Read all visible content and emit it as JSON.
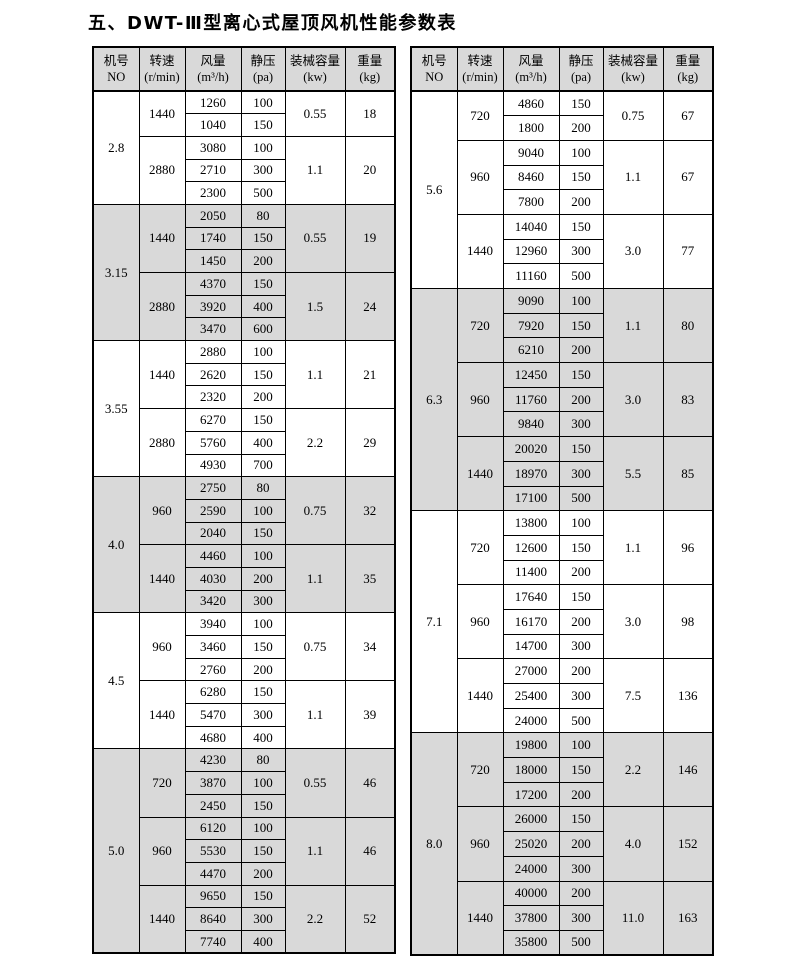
{
  "title": "五、DWT-Ⅲ型离心式屋顶风机性能参数表",
  "columns": [
    {
      "line1": "机号",
      "line2": "NO"
    },
    {
      "line1": "转速",
      "line2": "(r/min)"
    },
    {
      "line1": "风量",
      "line2": "(m³/h)"
    },
    {
      "line1": "静压",
      "line2": "(pa)"
    },
    {
      "line1": "装械容量",
      "line2": "(kw)"
    },
    {
      "line1": "重量",
      "line2": "(kg)"
    }
  ],
  "tables": [
    {
      "side": "left",
      "sections": [
        {
          "no": "2.8",
          "shaded": false,
          "groups": [
            {
              "speed": "1440",
              "rows": [
                [
                  "1260",
                  "100"
                ],
                [
                  "1040",
                  "150"
                ]
              ],
              "kw": "0.55",
              "kg": "18"
            },
            {
              "speed": "2880",
              "rows": [
                [
                  "3080",
                  "100"
                ],
                [
                  "2710",
                  "300"
                ],
                [
                  "2300",
                  "500"
                ]
              ],
              "kw": "1.1",
              "kg": "20"
            }
          ]
        },
        {
          "no": "3.15",
          "shaded": true,
          "groups": [
            {
              "speed": "1440",
              "rows": [
                [
                  "2050",
                  "80"
                ],
                [
                  "1740",
                  "150"
                ],
                [
                  "1450",
                  "200"
                ]
              ],
              "kw": "0.55",
              "kg": "19"
            },
            {
              "speed": "2880",
              "rows": [
                [
                  "4370",
                  "150"
                ],
                [
                  "3920",
                  "400"
                ],
                [
                  "3470",
                  "600"
                ]
              ],
              "kw": "1.5",
              "kg": "24"
            }
          ]
        },
        {
          "no": "3.55",
          "shaded": false,
          "groups": [
            {
              "speed": "1440",
              "rows": [
                [
                  "2880",
                  "100"
                ],
                [
                  "2620",
                  "150"
                ],
                [
                  "2320",
                  "200"
                ]
              ],
              "kw": "1.1",
              "kg": "21"
            },
            {
              "speed": "2880",
              "rows": [
                [
                  "6270",
                  "150"
                ],
                [
                  "5760",
                  "400"
                ],
                [
                  "4930",
                  "700"
                ]
              ],
              "kw": "2.2",
              "kg": "29"
            }
          ]
        },
        {
          "no": "4.0",
          "shaded": true,
          "groups": [
            {
              "speed": "960",
              "rows": [
                [
                  "2750",
                  "80"
                ],
                [
                  "2590",
                  "100"
                ],
                [
                  "2040",
                  "150"
                ]
              ],
              "kw": "0.75",
              "kg": "32"
            },
            {
              "speed": "1440",
              "rows": [
                [
                  "4460",
                  "100"
                ],
                [
                  "4030",
                  "200"
                ],
                [
                  "3420",
                  "300"
                ]
              ],
              "kw": "1.1",
              "kg": "35"
            }
          ]
        },
        {
          "no": "4.5",
          "shaded": false,
          "groups": [
            {
              "speed": "960",
              "rows": [
                [
                  "3940",
                  "100"
                ],
                [
                  "3460",
                  "150"
                ],
                [
                  "2760",
                  "200"
                ]
              ],
              "kw": "0.75",
              "kg": "34"
            },
            {
              "speed": "1440",
              "rows": [
                [
                  "6280",
                  "150"
                ],
                [
                  "5470",
                  "300"
                ],
                [
                  "4680",
                  "400"
                ]
              ],
              "kw": "1.1",
              "kg": "39"
            }
          ]
        },
        {
          "no": "5.0",
          "shaded": true,
          "groups": [
            {
              "speed": "720",
              "rows": [
                [
                  "4230",
                  "80"
                ],
                [
                  "3870",
                  "100"
                ],
                [
                  "2450",
                  "150"
                ]
              ],
              "kw": "0.55",
              "kg": "46"
            },
            {
              "speed": "960",
              "rows": [
                [
                  "6120",
                  "100"
                ],
                [
                  "5530",
                  "150"
                ],
                [
                  "4470",
                  "200"
                ]
              ],
              "kw": "1.1",
              "kg": "46"
            },
            {
              "speed": "1440",
              "rows": [
                [
                  "9650",
                  "150"
                ],
                [
                  "8640",
                  "300"
                ],
                [
                  "7740",
                  "400"
                ]
              ],
              "kw": "2.2",
              "kg": "52"
            }
          ]
        }
      ]
    },
    {
      "side": "right",
      "sections": [
        {
          "no": "5.6",
          "shaded": false,
          "groups": [
            {
              "speed": "720",
              "rows": [
                [
                  "4860",
                  "150"
                ],
                [
                  "1800",
                  "200"
                ]
              ],
              "kw": "0.75",
              "kg": "67"
            },
            {
              "speed": "960",
              "rows": [
                [
                  "9040",
                  "100"
                ],
                [
                  "8460",
                  "150"
                ],
                [
                  "7800",
                  "200"
                ]
              ],
              "kw": "1.1",
              "kg": "67"
            },
            {
              "speed": "1440",
              "rows": [
                [
                  "14040",
                  "150"
                ],
                [
                  "12960",
                  "300"
                ],
                [
                  "11160",
                  "500"
                ]
              ],
              "kw": "3.0",
              "kg": "77"
            }
          ]
        },
        {
          "no": "6.3",
          "shaded": true,
          "groups": [
            {
              "speed": "720",
              "rows": [
                [
                  "9090",
                  "100"
                ],
                [
                  "7920",
                  "150"
                ],
                [
                  "6210",
                  "200"
                ]
              ],
              "kw": "1.1",
              "kg": "80"
            },
            {
              "speed": "960",
              "rows": [
                [
                  "12450",
                  "150"
                ],
                [
                  "11760",
                  "200"
                ],
                [
                  "9840",
                  "300"
                ]
              ],
              "kw": "3.0",
              "kg": "83"
            },
            {
              "speed": "1440",
              "rows": [
                [
                  "20020",
                  "150"
                ],
                [
                  "18970",
                  "300"
                ],
                [
                  "17100",
                  "500"
                ]
              ],
              "kw": "5.5",
              "kg": "85"
            }
          ]
        },
        {
          "no": "7.1",
          "shaded": false,
          "groups": [
            {
              "speed": "720",
              "rows": [
                [
                  "13800",
                  "100"
                ],
                [
                  "12600",
                  "150"
                ],
                [
                  "11400",
                  "200"
                ]
              ],
              "kw": "1.1",
              "kg": "96"
            },
            {
              "speed": "960",
              "rows": [
                [
                  "17640",
                  "150"
                ],
                [
                  "16170",
                  "200"
                ],
                [
                  "14700",
                  "300"
                ]
              ],
              "kw": "3.0",
              "kg": "98"
            },
            {
              "speed": "1440",
              "rows": [
                [
                  "27000",
                  "200"
                ],
                [
                  "25400",
                  "300"
                ],
                [
                  "24000",
                  "500"
                ]
              ],
              "kw": "7.5",
              "kg": "136"
            }
          ]
        },
        {
          "no": "8.0",
          "shaded": true,
          "groups": [
            {
              "speed": "720",
              "rows": [
                [
                  "19800",
                  "100"
                ],
                [
                  "18000",
                  "150"
                ],
                [
                  "17200",
                  "200"
                ]
              ],
              "kw": "2.2",
              "kg": "146"
            },
            {
              "speed": "960",
              "rows": [
                [
                  "26000",
                  "150"
                ],
                [
                  "25020",
                  "200"
                ],
                [
                  "24000",
                  "300"
                ]
              ],
              "kw": "4.0",
              "kg": "152"
            },
            {
              "speed": "1440",
              "rows": [
                [
                  "40000",
                  "200"
                ],
                [
                  "37800",
                  "300"
                ],
                [
                  "35800",
                  "500"
                ]
              ],
              "kw": "11.0",
              "kg": "163"
            }
          ]
        }
      ]
    }
  ]
}
